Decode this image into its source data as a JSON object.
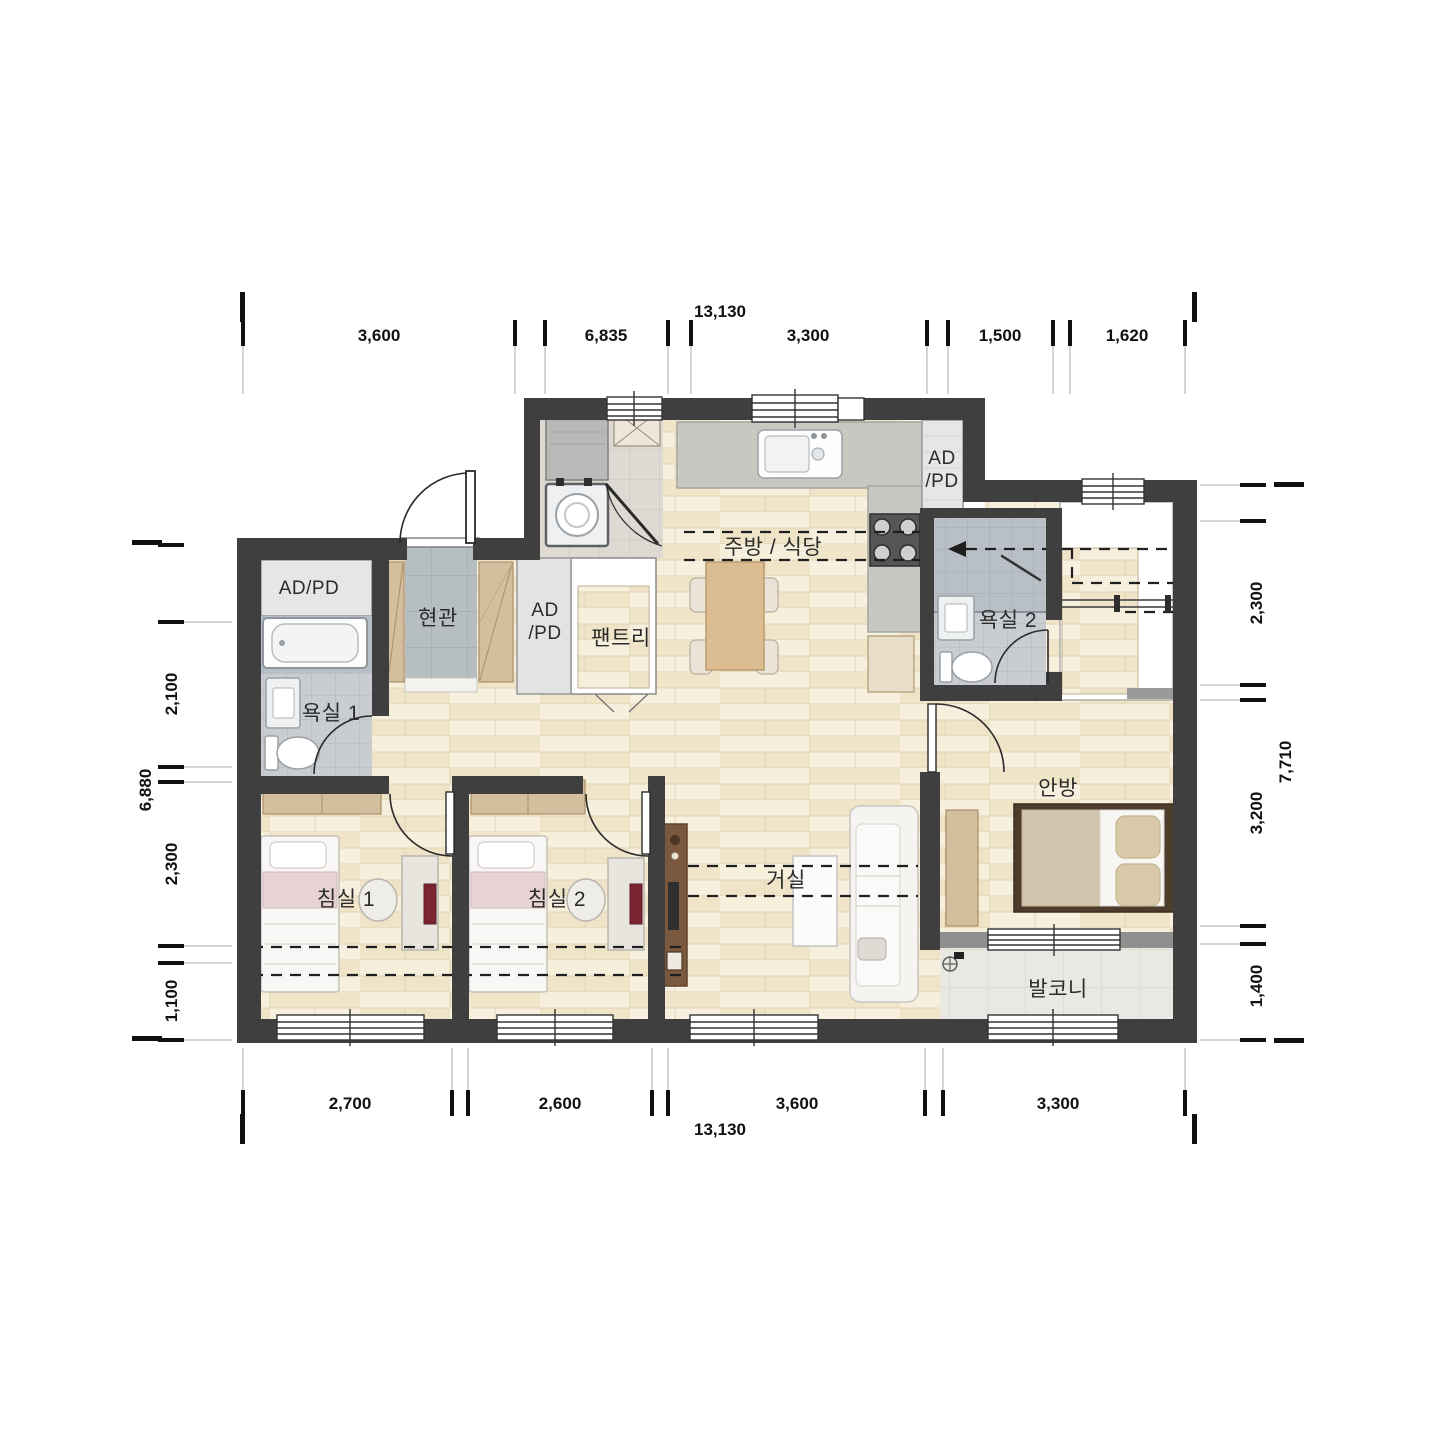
{
  "plan": {
    "type": "apartment-floor-plan",
    "units": "mm"
  },
  "dimensions": {
    "top": {
      "total": "13,130",
      "segments": [
        "3,600",
        "6,835",
        "3,300",
        "1,500",
        "1,620"
      ]
    },
    "bottom": {
      "total": "13,130",
      "segments": [
        "2,700",
        "2,600",
        "3,600",
        "3,300"
      ]
    },
    "left": {
      "total": "6,880",
      "segments": [
        "2,100",
        "2,300",
        "1,100"
      ]
    },
    "right": {
      "total": "7,710",
      "segments": [
        "2,300",
        "3,200",
        "1,400"
      ]
    }
  },
  "rooms": {
    "ad_pd_1": "AD/PD",
    "bath_1": "욕실 1",
    "entrance": "현관",
    "ad_pd_2_line1": "AD",
    "ad_pd_2_line2": "/PD",
    "pantry": "팬트리",
    "kitchen_dining": "주방 / 식당",
    "ad_pd_3_line1": "AD",
    "ad_pd_3_line2": "/PD",
    "bath_2": "욕실 2",
    "bedroom_1": "침실 1",
    "bedroom_2": "침실 2",
    "living": "거실",
    "master_bedroom": "안방",
    "balcony": "발코니"
  },
  "colors": {
    "wall": "#3f3f3f",
    "wood_floor": "#f4ecd7",
    "entry_tile": "#b6bec1",
    "bath_tile": "#c9cdd2",
    "shower_tile": "#b9bfc7",
    "balcony_tile": "#eae8e3",
    "counter": "#c7c8c2",
    "furniture_beige": "#d3bf9e",
    "accent_maroon": "#7d2433"
  }
}
